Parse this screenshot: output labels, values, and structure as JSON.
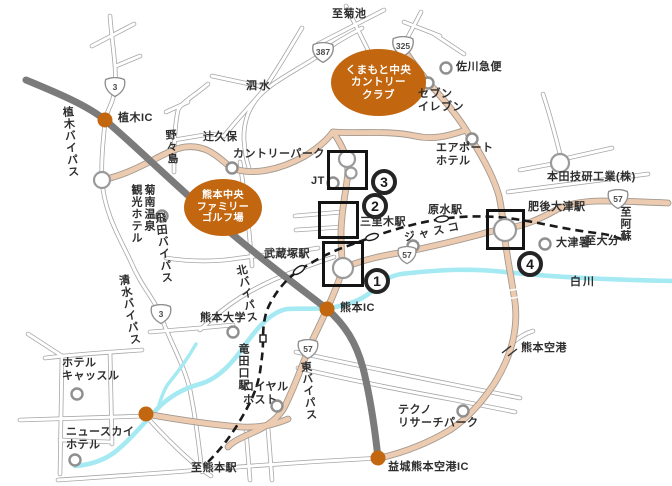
{
  "map_title": "Kumamoto area access map",
  "colors": {
    "accent_orange": "#c2660f",
    "road_tan": "#eccbb0",
    "expressway_gray": "#7b7b7b",
    "river_blue": "#a5e9f2",
    "railway_black": "#1a1a1a",
    "highlight_black": "#141414"
  },
  "labels": {
    "dest_kikuchi": "至菊池",
    "shisui": "泗水",
    "tsujikubo": "辻久保",
    "country_park": "カントリーパーク",
    "nonoshima": "野々島",
    "ueki_ic": "植木IC",
    "ueki_bypass": "植木バイパス",
    "kikunan_hotel": "菊南温泉\n観光ホテル",
    "hida_bypass": "飛田バイパス",
    "shimizu_bypass": "清水バイパス",
    "kita_bypass": "北バイパス",
    "jt": "JT",
    "sanrigi_sta": "三里木駅",
    "musashizuka_sta": "武蔵塚駅",
    "haramizu_sta": "原水駅",
    "jusco": "ジャスコ",
    "seven_eleven": "セブン\nイレブン",
    "sagawa": "佐川急便",
    "airport_hotel": "エアポート\nホテル",
    "honda": "本田技研工業(株)",
    "higo_ozu_sta": "肥後大津駅",
    "ozu_police": "大津署",
    "dest_oita": "至大分",
    "dest_aso": "至阿蘇",
    "shirakawa": "白川",
    "kumamoto_ic": "熊本IC",
    "kumamoto_univ": "熊本大学",
    "tatsutaguchi_sta": "竜田口駅",
    "higashi_bypass": "東バイパス",
    "hotel_castle": "ホテル\nキャッスル",
    "new_sky_hotel": "ニュースカイ\nホテル",
    "royal_host": "ロイヤル\nホスト",
    "dest_kumamoto_sta": "至熊本駅",
    "kumamoto_airport": "熊本空港",
    "techno_research": "テクノ\nリサーチパーク",
    "mashiki_ic": "益城熊本空港IC"
  },
  "ellipses": {
    "cc": {
      "l1": "くまもと中央",
      "l2": "カントリー",
      "l3": "クラブ"
    },
    "golf": {
      "l1": "熊本中央",
      "l2": "ファミリー",
      "l3": "ゴルフ場"
    }
  },
  "shields": {
    "s3_north": "3",
    "s387": "387",
    "s325": "325",
    "s3_south": "3",
    "s57_mid": "57",
    "s57_east": "57",
    "s57_higashi": "57"
  },
  "badges": {
    "b1": "1",
    "b2": "2",
    "b3": "3",
    "b4": "4"
  }
}
